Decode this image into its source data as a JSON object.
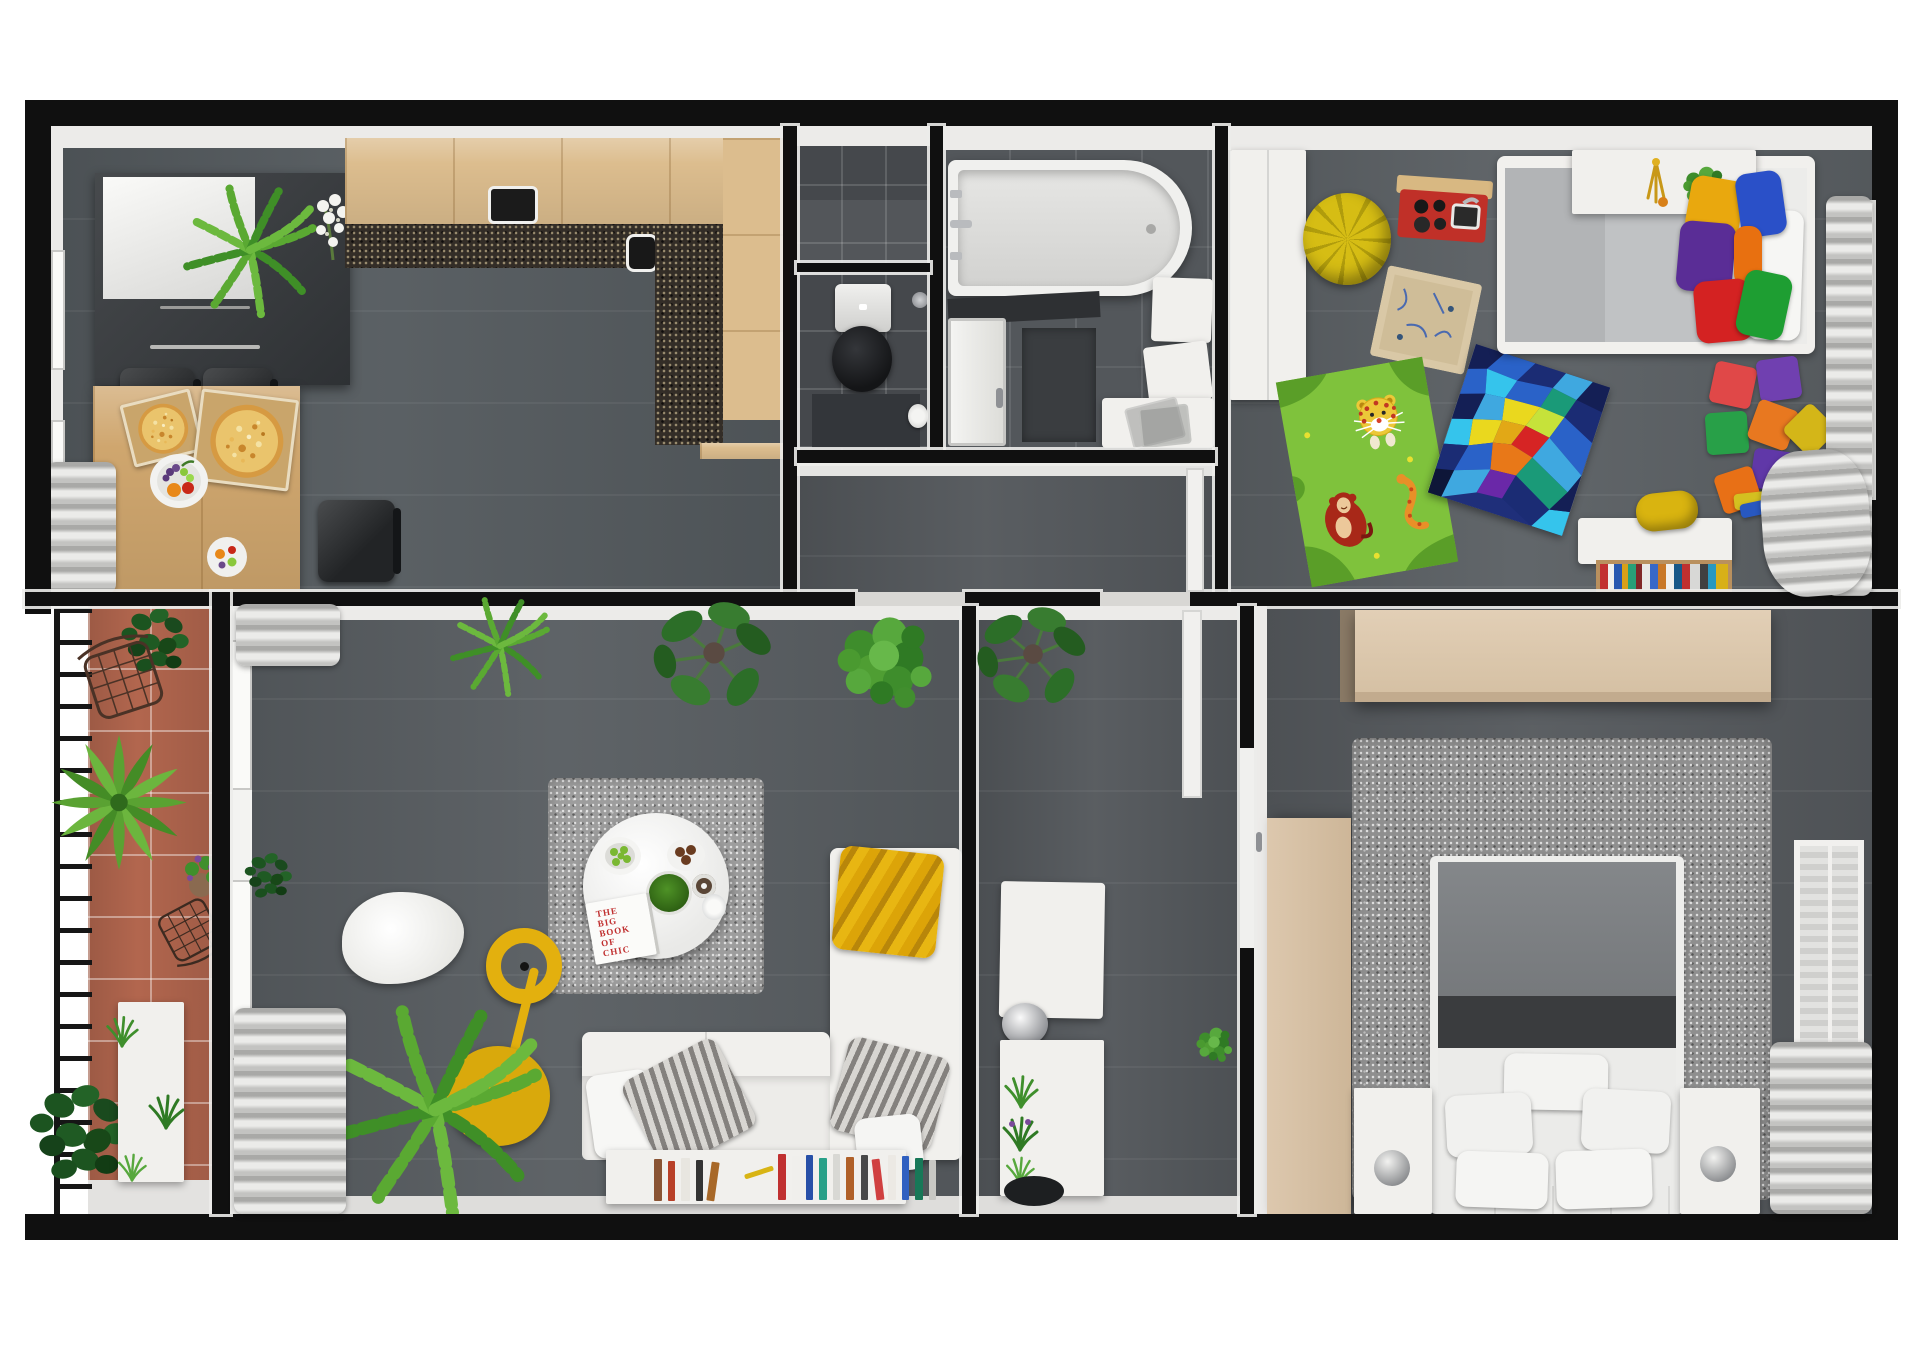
{
  "scene": {
    "description": "3D rendered top-down floor plan of an apartment on a white background",
    "background_color": "#ffffff",
    "wall_color": "#101010"
  },
  "palette": {
    "floor_gray": "#585d61",
    "dark_tile": "#45484c",
    "light_tile": "#53575b",
    "wood_light": "#dcbd8e",
    "countertop_dark": "#332d27",
    "terracotta": "#b2664e",
    "furniture_white": "#f1f0ed",
    "wardrobe_beige": "#dcc7ad",
    "accent_yellow": "#deac0e",
    "rug_gray": "#9d9d9d"
  },
  "rooms": [
    {
      "id": "kitchen-dining-room",
      "position": "top-left",
      "items": [
        "fridge cabinet",
        "palm plant",
        "white flowers",
        "L-shaped kitchen counter",
        "cooktop",
        "sink",
        "two black bar chairs",
        "black chair",
        "wooden dining table",
        "two pizza boxes with pizzas",
        "fruit bowl",
        "fruit plate",
        "window curtain"
      ]
    },
    {
      "id": "storage-niche",
      "position": "top-middle-upper",
      "items": [
        "dark wall tiles"
      ]
    },
    {
      "id": "wc",
      "position": "top-middle",
      "items": [
        "toilet with black lid",
        "dark floor mat",
        "toilet paper holder",
        "shower head"
      ]
    },
    {
      "id": "bathroom",
      "position": "top-middle-right",
      "items": [
        "bathtub",
        "faucet",
        "dark counter",
        "white door",
        "dark bath mat",
        "two white wall cabinets",
        "vanity with leaning glass panels"
      ]
    },
    {
      "id": "kids-room",
      "position": "top-right",
      "items": [
        "white wardrobe",
        "yellow bean bag",
        "red toy play kitchen",
        "cardboard toy box",
        "green animal rug with leopard monkey and snake",
        "colorful mosaic rug",
        "single bed with gray mattress",
        "headboard shelf with lamp and plant",
        "six colorful pillows",
        "white pillow",
        "colorful foam blocks",
        "white desk",
        "yellow chair",
        "book rack with books",
        "gray curtain",
        "window"
      ]
    },
    {
      "id": "corridor",
      "position": "middle",
      "items": [
        "white door frame",
        "door thresholds"
      ]
    },
    {
      "id": "balcony",
      "position": "left",
      "items": [
        "black railing",
        "terracotta tile floor",
        "two wire chairs",
        "green bush",
        "rosette plant",
        "flower pot",
        "fiddle leaf plant",
        "white planter box",
        "small plants"
      ]
    },
    {
      "id": "living-room",
      "position": "bottom-left",
      "items": [
        "window curtains",
        "three green plants",
        "gray shag rug",
        "round white coffee table",
        "salad bowl",
        "moss bowl",
        "plate with chocolates",
        "cup",
        "glass",
        "book titled THE BIG BOOK OF CHIC",
        "white sheepskin rug",
        "yellow ring floor lamp",
        "large palm plant",
        "white corner sofa",
        "yellow throw blanket",
        "two striped pillows",
        "white pillows",
        "low white shelf with books and pen"
      ]
    },
    {
      "id": "entry-hall",
      "position": "bottom-middle",
      "items": [
        "monstera plant",
        "white wall cabinet",
        "metal bowl",
        "white console with potted plants",
        "black round doormat",
        "small green plant",
        "white door"
      ]
    },
    {
      "id": "bedroom",
      "position": "bottom-right",
      "items": [
        "beige wardrobe",
        "beige side wardrobe",
        "gray shag rug",
        "double bed with gray upholstered top",
        "dark gray runner",
        "white duvet",
        "five white pillows",
        "two white nightstands",
        "two decorative spheres",
        "gray curtain",
        "open window"
      ]
    }
  ],
  "living_room": {
    "book_title_lines": [
      "THE",
      "BIG",
      "BOOK",
      "OF",
      "CHIC"
    ]
  }
}
